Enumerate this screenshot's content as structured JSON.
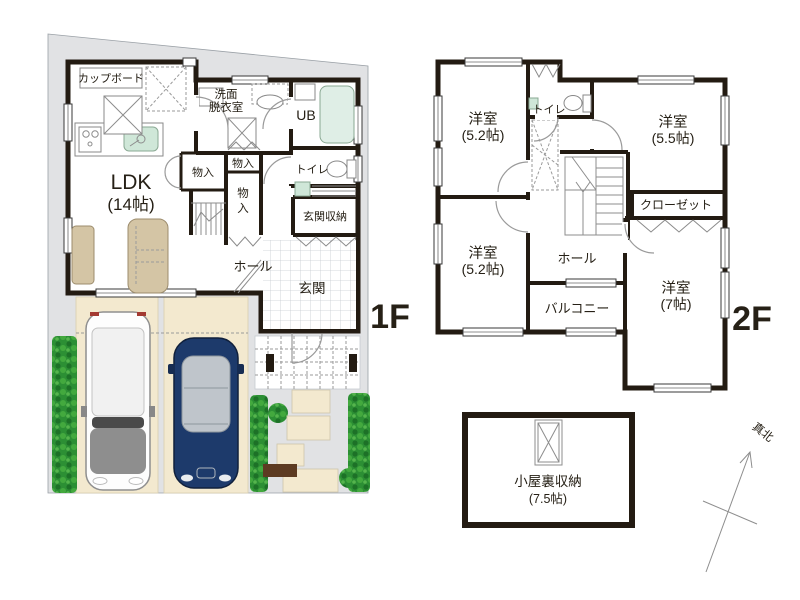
{
  "plans": {
    "floor1": {
      "label": "1F",
      "rooms": {
        "cupboard": "カップボード",
        "washroom_l1": "洗面",
        "washroom_l2": "脱衣室",
        "ub": "UB",
        "closet_a": "物入",
        "closet_b": "物入",
        "closet_c_l1": "物",
        "closet_c_l2": "入",
        "toilet": "トイレ",
        "entrance_storage": "玄関収納",
        "ldk": "LDK",
        "ldk_size": "(14帖)",
        "hall": "ホール",
        "entrance": "玄関"
      }
    },
    "floor2": {
      "label": "2F",
      "rooms": {
        "room_nw": "洋室",
        "room_nw_size": "(5.2帖)",
        "toilet": "トイレ",
        "room_ne": "洋室",
        "room_ne_size": "(5.5帖)",
        "closet": "クローゼット",
        "room_sw": "洋室",
        "room_sw_size": "(5.2帖)",
        "hall": "ホール",
        "balcony": "バルコニー",
        "room_se": "洋室",
        "room_se_size": "(7帖)"
      }
    },
    "attic": {
      "name": "小屋裏収納",
      "size": "(7.5帖)"
    },
    "compass": {
      "label": "真北"
    }
  },
  "colors": {
    "wall": "#231b12",
    "lot": "#e1e2e4",
    "parking_pad": "#f3e9cf",
    "bathtub": "#dfeee6",
    "sink": "#cfe7d8",
    "furniture": "#d4c5a5",
    "hedge": "#2c8f34",
    "car_blue": "#1d3a6b",
    "car_white": "#fdfdfd",
    "text": "#262016"
  }
}
